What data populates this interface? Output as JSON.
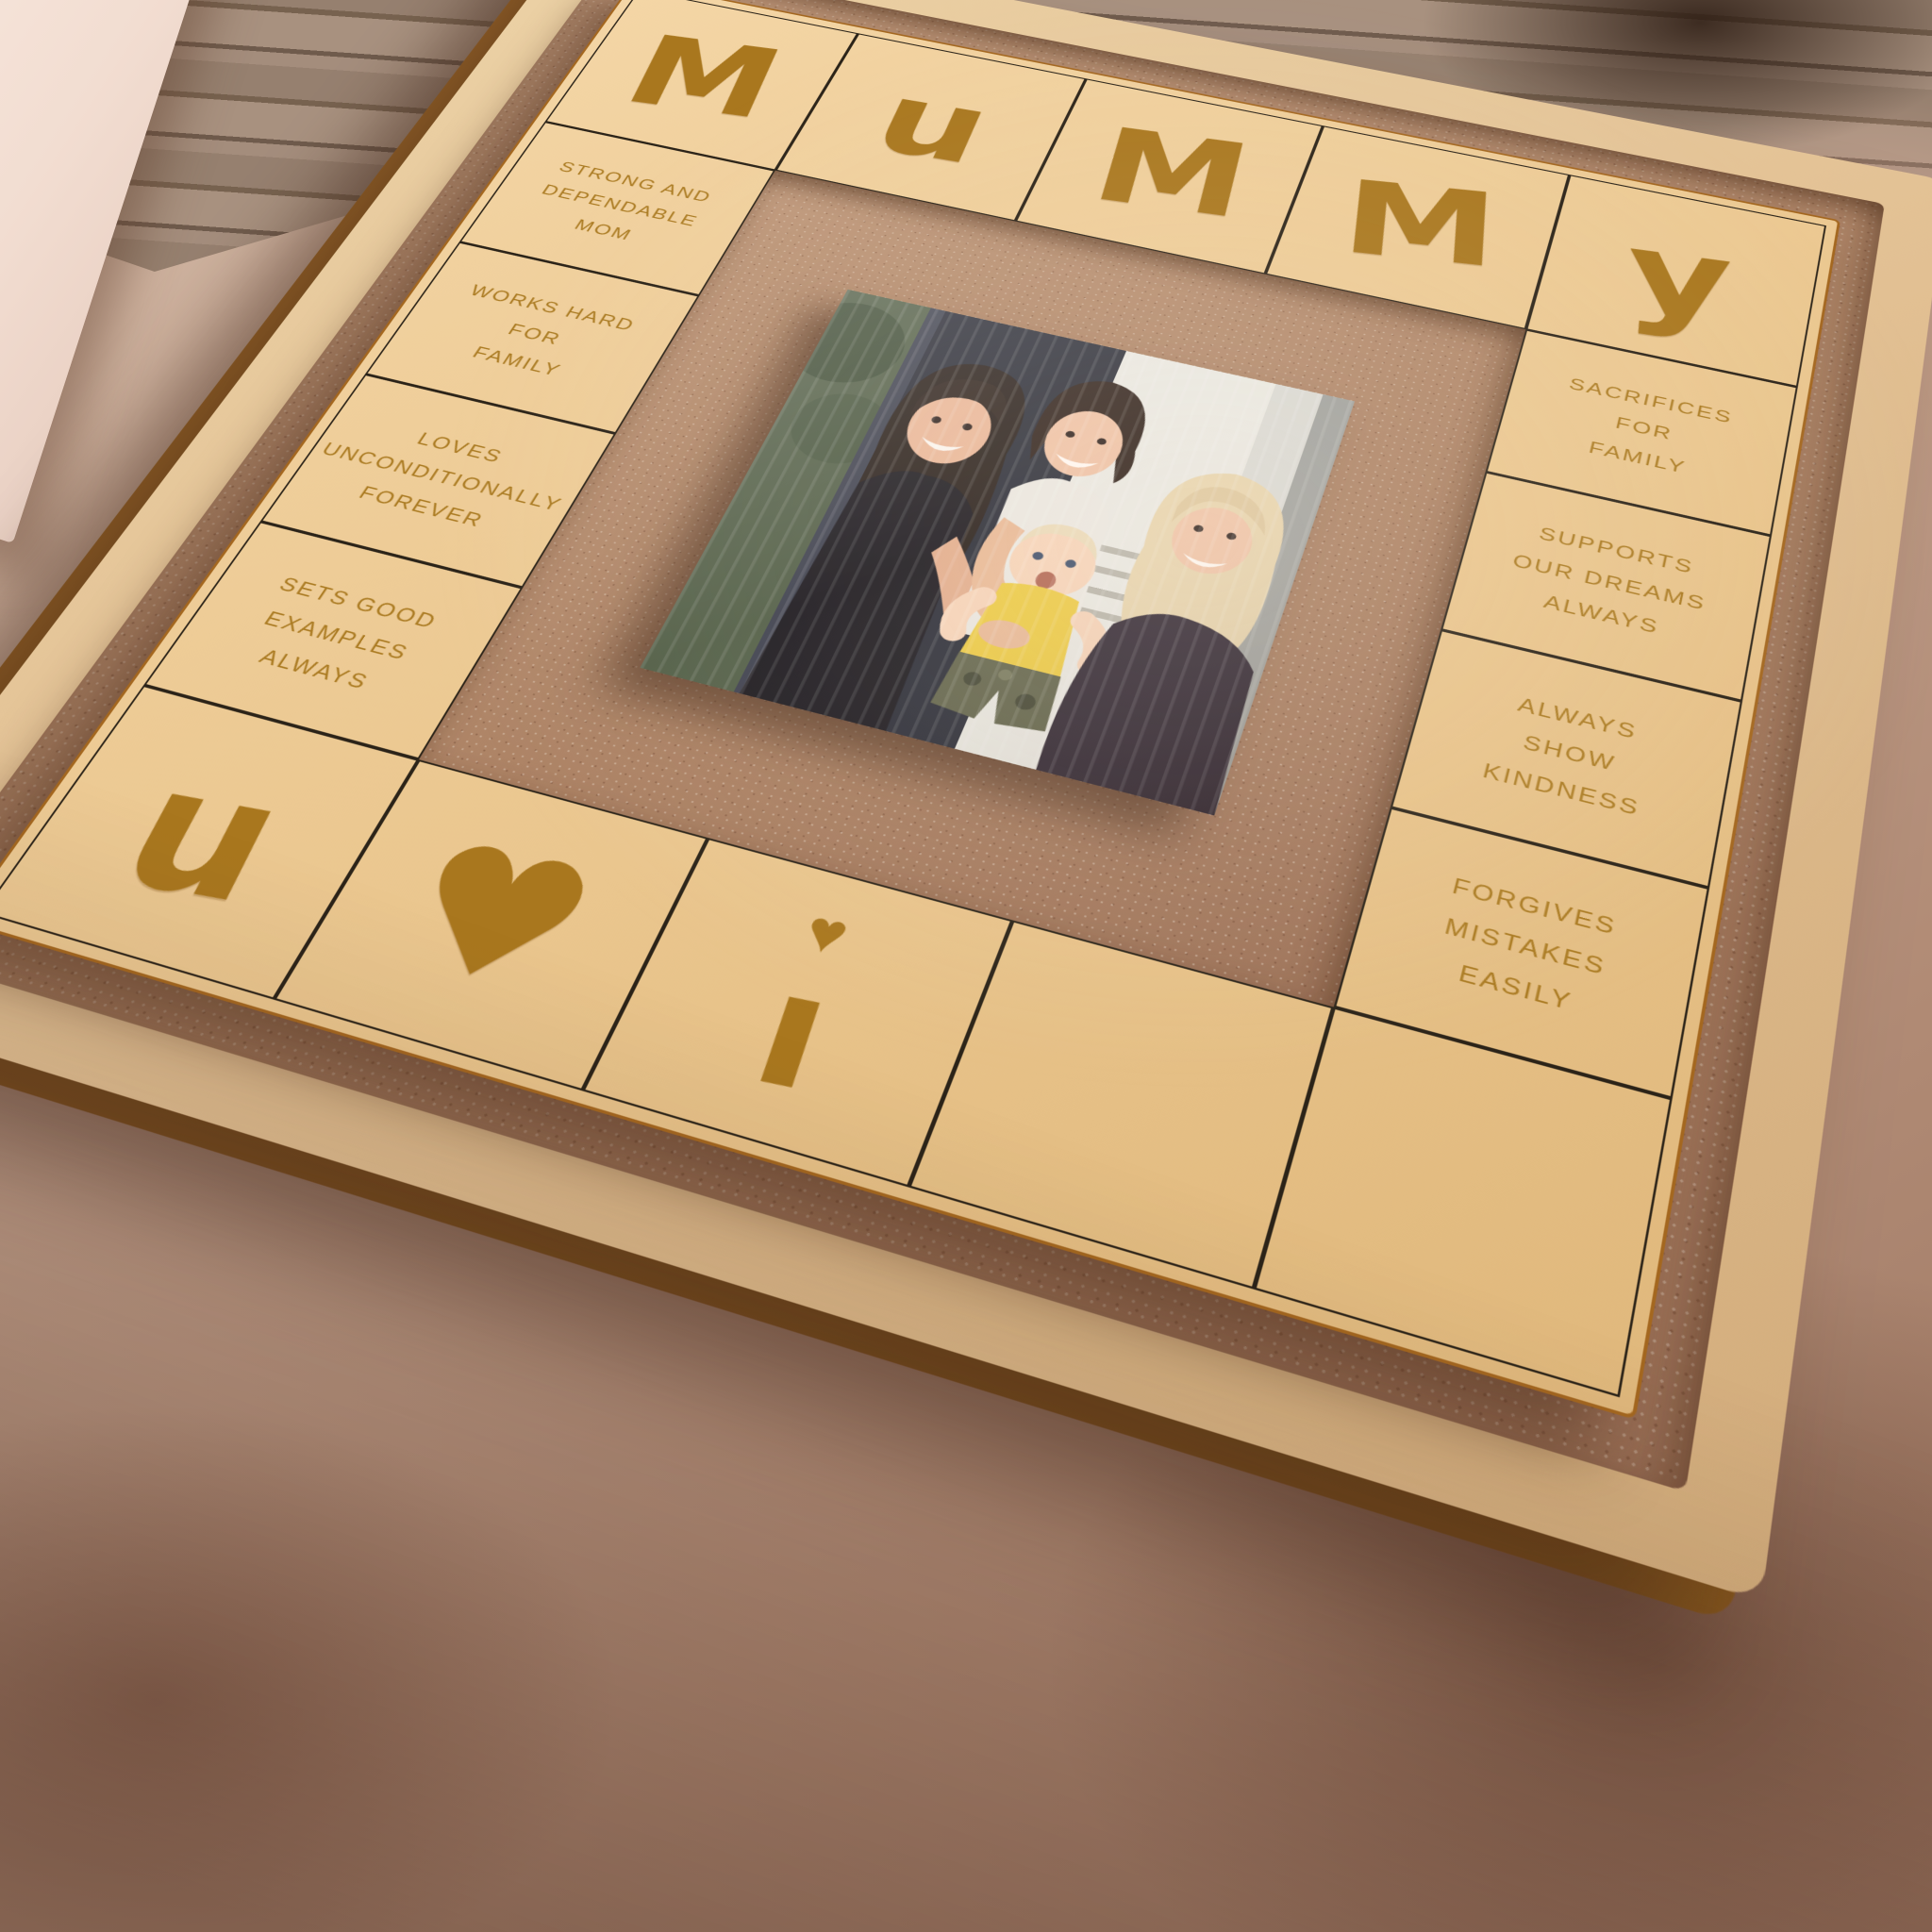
{
  "colors": {
    "suede_background": "#c3a18c",
    "wood_plank": "#96806f",
    "frame_wood": "#e2c093",
    "panel_gold": "#eac68e",
    "engraving": "#a9771e",
    "grid_line": "#2b2318",
    "plywood_edge": "#a4671f",
    "white_card": "#f7eae1",
    "baby_outfit_yellow": "#ecc93f"
  },
  "board": {
    "title_word": "MUMMY",
    "top_letters": [
      "M",
      "u",
      "M",
      "M",
      "y"
    ],
    "left_tiles": [
      "STRONG AND\nDEPENDABLE\nMOM",
      "WORKS HARD\nFOR\nFAMILY",
      "LOVES\nUNCONDITIONALLY\nFOREVER",
      "SETS GOOD\nEXAMPLES\nALWAYS"
    ],
    "right_tiles": [
      "SACRIFICES\nFOR\nFAMILY",
      "SUPPORTS\nOUR DREAMS\nALWAYS",
      "ALWAYS\nSHOW\nKINDNESS",
      "FORGIVES\nMISTAKES\nEASILY"
    ],
    "bottom_row": {
      "letter_u": "u",
      "heart": "♥",
      "i_stem": "ı",
      "i_dot": "♥",
      "reads": "u ♥ i"
    }
  }
}
